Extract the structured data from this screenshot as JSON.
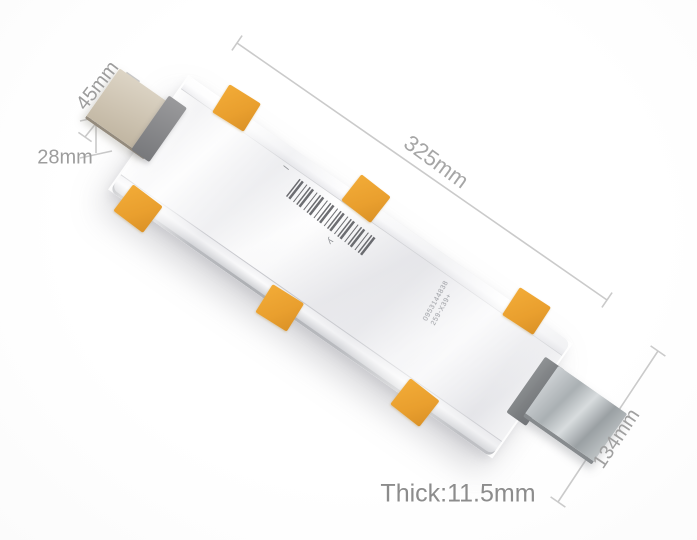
{
  "scene": {
    "description": "Silver lithium-ion pouch battery cell photographed diagonally on a white background with gray dimension callouts",
    "background_color": "#ffffff"
  },
  "dimensions": {
    "tab_width": "45mm",
    "tab_stub": "28mm",
    "cell_length": "325mm",
    "cell_width": "134mm",
    "thickness": "Thick:11.5mm"
  },
  "battery": {
    "pouch_color": "#efeff2",
    "tape_color": "#eaa339",
    "tape_count": 6,
    "left_tab_color": "#c9bfae",
    "right_tab_color": "#b4b9bc",
    "polarity_mark": "–",
    "print_mark": "y",
    "serial_line1": "0953144838",
    "serial_line2": "259-X39+"
  },
  "annotation_style": {
    "line_color": "#c7c7c7",
    "text_color": "#9d9d9d"
  }
}
